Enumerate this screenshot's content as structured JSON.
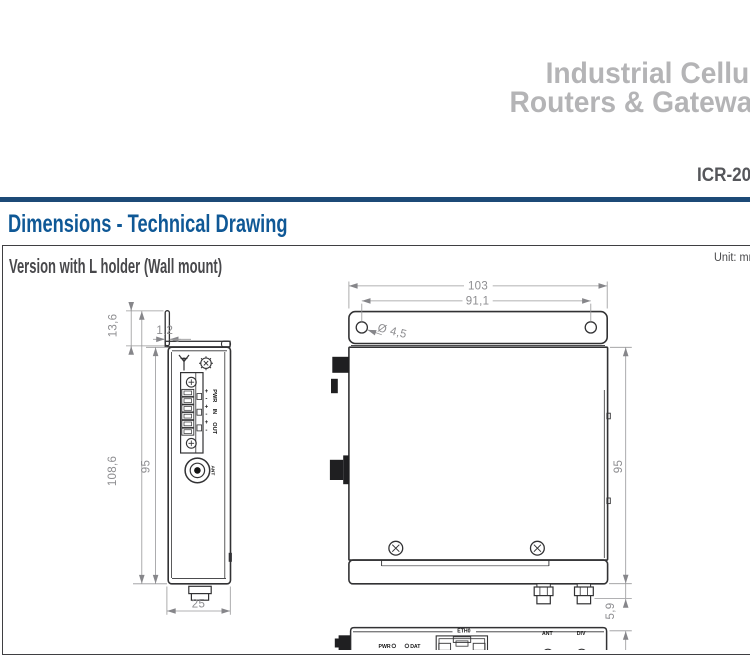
{
  "header": {
    "brand_line1": "Industrial Cellular",
    "brand_line2": "Routers & Gateways",
    "model": "ICR-20"
  },
  "section": {
    "title": "Dimensions - Technical Drawing"
  },
  "panel": {
    "subtitle": "Version with L holder (Wall mount)",
    "unit_note": "Unit: mm"
  },
  "side_view": {
    "dimensions": {
      "bracket_tab_height": "13,6",
      "bracket_thickness": "1,2",
      "overall_height": "108,6",
      "body_height": "95",
      "body_depth": "25"
    },
    "connector_labels": {
      "plus": "+",
      "minus": "-",
      "pwr": "PWR",
      "in": "IN",
      "out": "OUT",
      "ant": "ANT"
    }
  },
  "front_view": {
    "dimensions": {
      "bracket_width": "103",
      "hole_spacing": "91,1",
      "hole_diameter": "Ø 4,5",
      "body_height": "95",
      "connector_protrusion": "5,9"
    }
  },
  "bottom_view": {
    "labels": {
      "pwr": "PWR",
      "dat": "DAT",
      "eth0": "ETH0",
      "ant": "ANT",
      "div": "DIV"
    }
  },
  "colors": {
    "brand_grey": "#b4b4b6",
    "model_grey": "#55565a",
    "rule_blue": "#1c4a77",
    "heading_blue": "#0f5896",
    "drawing_line": "#323234",
    "dimension_grey": "#8d8d90"
  }
}
